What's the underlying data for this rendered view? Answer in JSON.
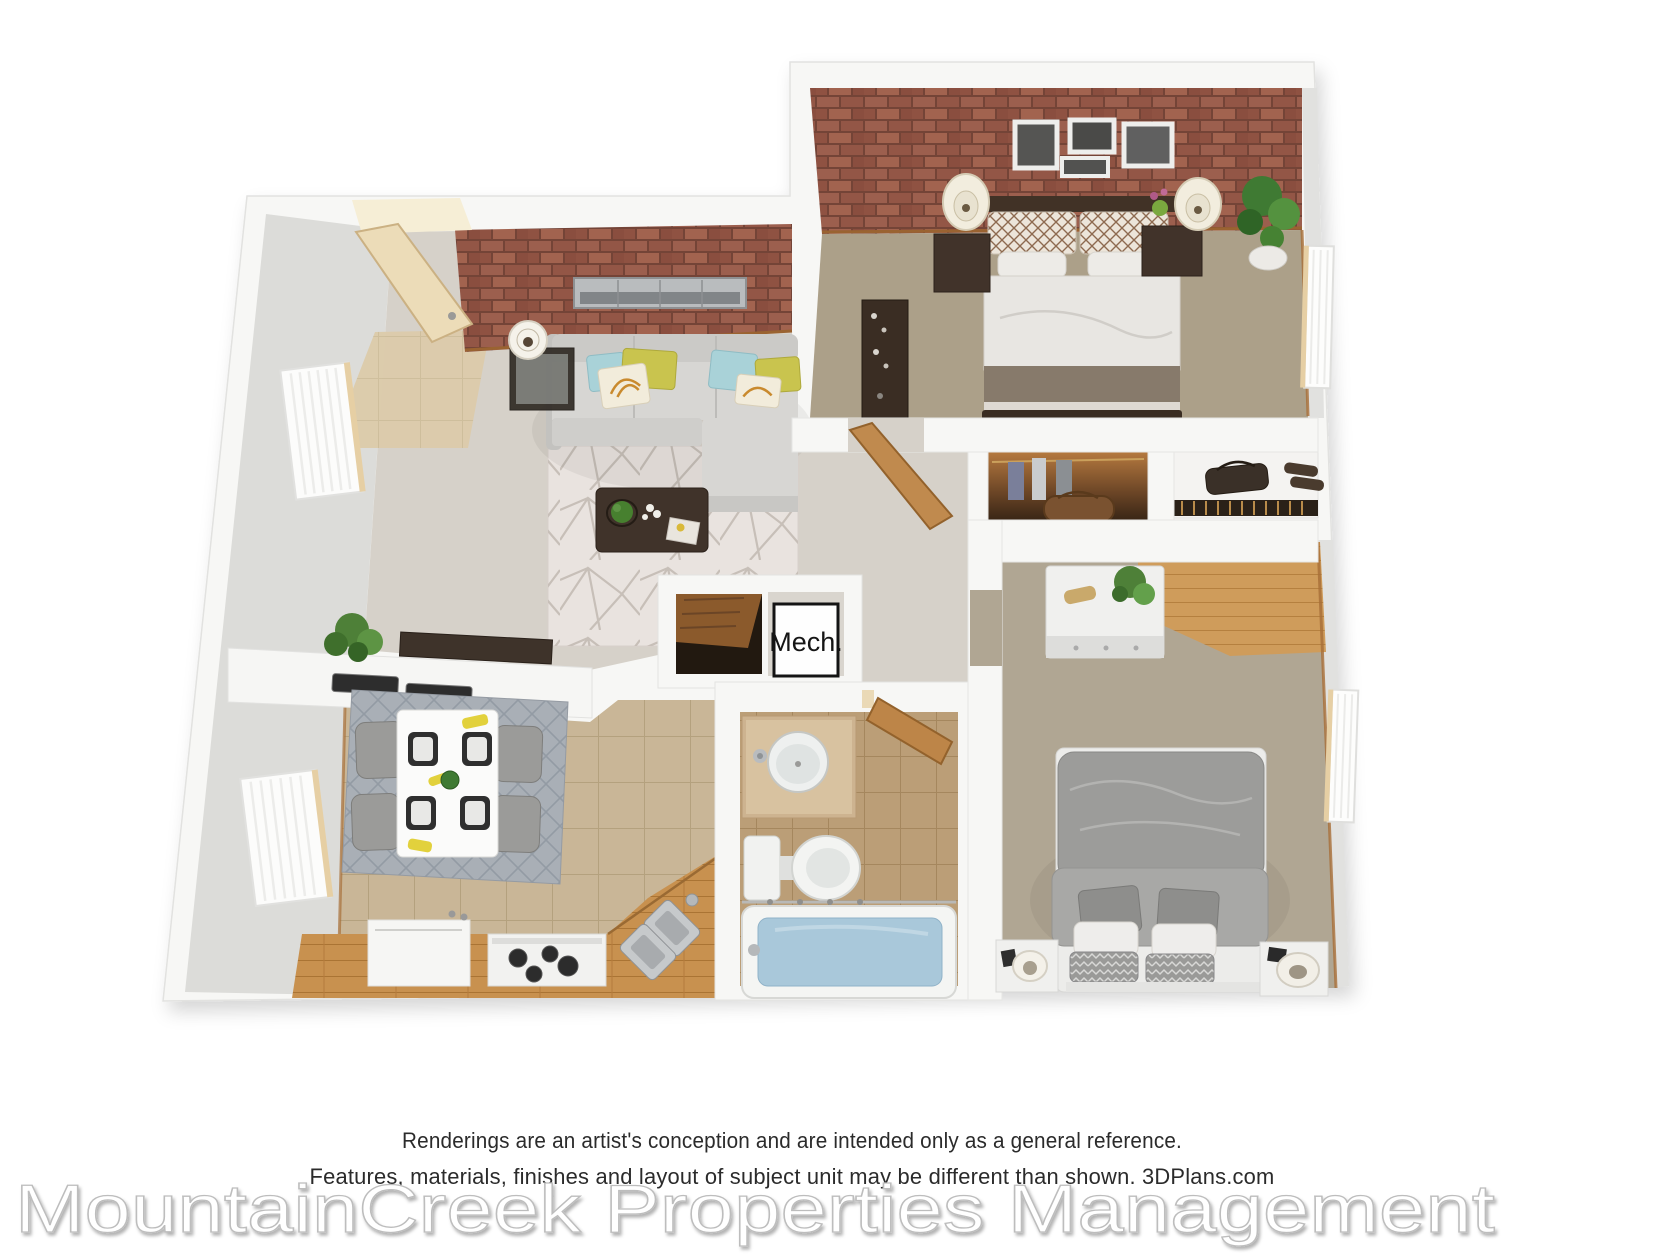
{
  "floor_plan": {
    "labels": {
      "mech_closet": "Mech."
    },
    "rooms": [
      {
        "name": "living-room",
        "floor": "carpet",
        "features": [
          "brick-accent-wall",
          "entry-door",
          "sectional-sofa",
          "accent-pillows",
          "geometric-rug",
          "coffee-table",
          "side-table-with-lamp",
          "panoramic-wall-art",
          "window"
        ]
      },
      {
        "name": "master-bedroom",
        "floor": "carpet",
        "features": [
          "brick-accent-wall",
          "four-picture-frames",
          "bed",
          "two-nightstands",
          "two-lamps",
          "tall-dresser",
          "potted-plant",
          "window"
        ]
      },
      {
        "name": "second-bedroom",
        "floor": "carpet",
        "features": [
          "bed",
          "two-nightstands",
          "two-lamps",
          "dresser-with-plant",
          "wood-floor-nook",
          "window"
        ]
      },
      {
        "name": "kitchen",
        "floor": "tile",
        "features": [
          "wood-counters",
          "refrigerator",
          "range-with-burners",
          "corner-double-sink",
          "window"
        ]
      },
      {
        "name": "dining-area",
        "floor": "tile",
        "features": [
          "breakfast-bar",
          "placemats",
          "plant",
          "table-for-four",
          "four-chairs",
          "lattice-rug"
        ]
      },
      {
        "name": "bathroom",
        "floor": "tile",
        "features": [
          "vanity-round-sink",
          "toilet",
          "bathtub-with-water",
          "door"
        ]
      },
      {
        "name": "hallway",
        "floor": "carpet",
        "features": [
          "closet-with-clothes",
          "closet-with-shelf",
          "mechanical-closet",
          "bedroom-door"
        ]
      }
    ],
    "colors": {
      "walls": "#f7f7f5",
      "brick": "#9c5f4e",
      "carpet_living": "#d6d1c9",
      "carpet_master": "#aca089",
      "carpet_bedroom2": "#b0a693",
      "tile_kitchen": "#c9b697",
      "tile_bath": "#bb9e77",
      "tile_entry": "#dccbaa",
      "wood": "#c8914f",
      "tub_water": "#a9c8da",
      "accent_teal": "#a9d2d8",
      "accent_yellow": "#c9c44e"
    }
  },
  "footer": {
    "disclaimer_line1": "Renderings are an artist's conception and are intended only as a general reference.",
    "disclaimer_line2": "Features, materials, finishes and layout of subject unit may be different than shown. 3DPlans.com",
    "watermark": "MountainCreek Properties Management"
  }
}
